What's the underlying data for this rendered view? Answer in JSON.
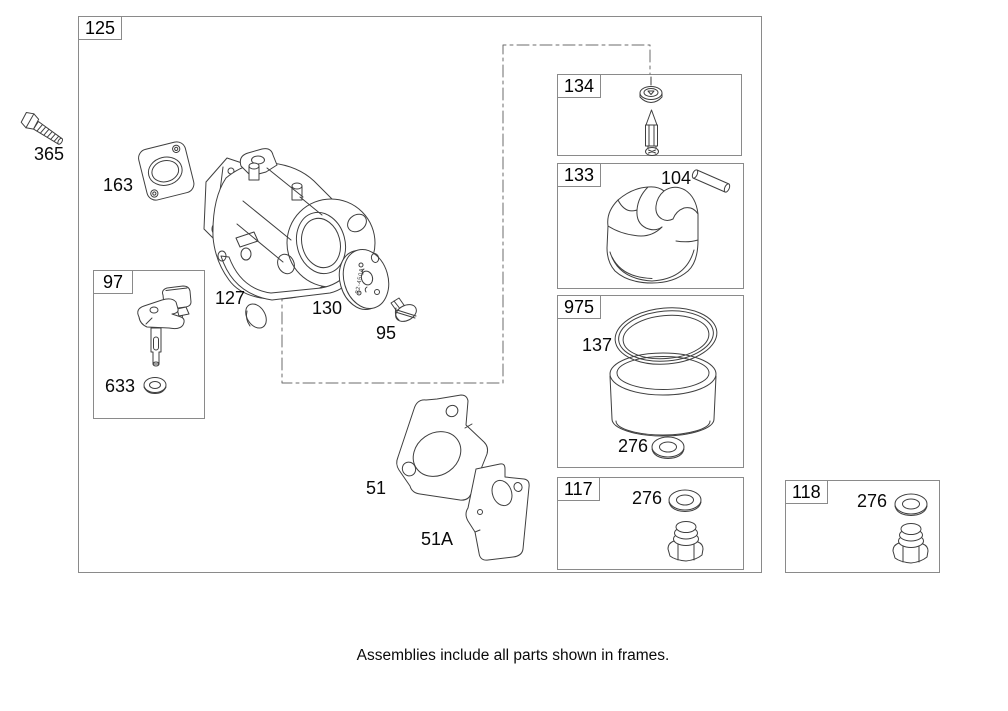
{
  "colors": {
    "background": "#ffffff",
    "line_art": "#3f3f3f",
    "frame_border": "#8a8a8a",
    "text": "#000000"
  },
  "caption": "Assemblies include all parts shown in frames.",
  "frames": {
    "f125": {
      "label": "125"
    },
    "f97": {
      "label": "97"
    },
    "f134": {
      "label": "134"
    },
    "f133": {
      "label": "133"
    },
    "f975": {
      "label": "975"
    },
    "f117": {
      "label": "117"
    },
    "f118": {
      "label": "118"
    }
  },
  "parts": {
    "bolt_365": {
      "label": "365"
    },
    "gasket_163": {
      "label": "163"
    },
    "welch_plug_127": {
      "label": "127"
    },
    "throttle_plate_130": {
      "label": "130",
      "stamp": "22-450A"
    },
    "screw_95": {
      "label": "95"
    },
    "seal_633": {
      "label": "633"
    },
    "gasket_51": {
      "label": "51"
    },
    "plate_51a": {
      "label": "51A"
    },
    "hinge_pin_104": {
      "label": "104"
    },
    "oring_137": {
      "label": "137"
    },
    "washer_276_bowl": {
      "label": "276"
    },
    "washer_276_f117": {
      "label": "276"
    },
    "washer_276_f118": {
      "label": "276"
    }
  }
}
